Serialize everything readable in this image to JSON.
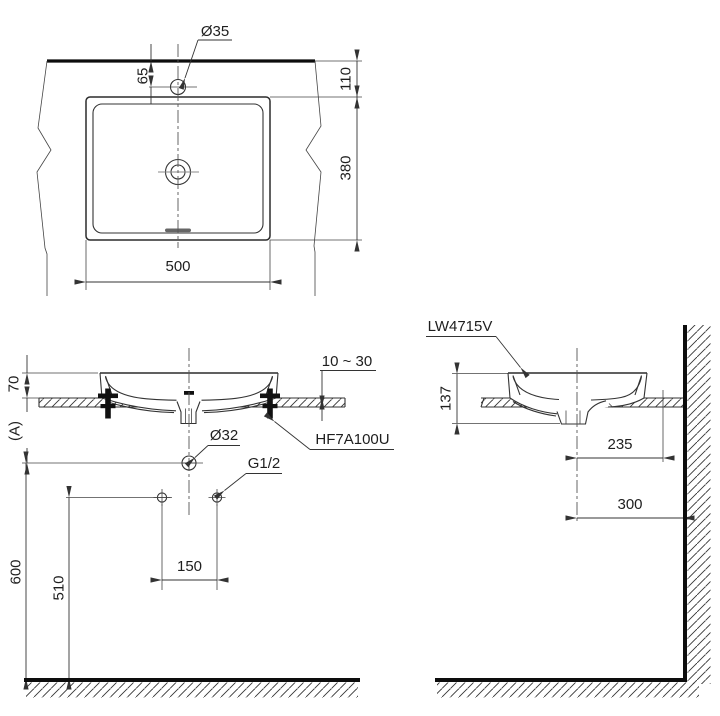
{
  "title": "LW4715V vessel lavatory installation drawing",
  "labels": {
    "product_code": "LW4715V",
    "fitting_code": "HF7A100U",
    "faucet_hole_dia": "Ø35",
    "drain_dia": "Ø32",
    "supply_thread": "G1/2",
    "counter_thickness": "10 ~ 30",
    "counter_height_ref": "(A)"
  },
  "dims": {
    "plan": {
      "faucet_offset": "65",
      "back_edge_to_rim": "110",
      "rim_depth": "380",
      "rim_width": "500"
    },
    "front": {
      "rim_above_counter": "70",
      "supply_spacing": "150",
      "supply_height": "510",
      "drain_line_height": "600"
    },
    "side": {
      "basin_height": "137",
      "fixing_to_wall": "235",
      "center_to_wall": "300"
    }
  },
  "colors": {
    "line": "#333333",
    "heavy_line": "#0d0d0d",
    "background": "#ffffff"
  }
}
